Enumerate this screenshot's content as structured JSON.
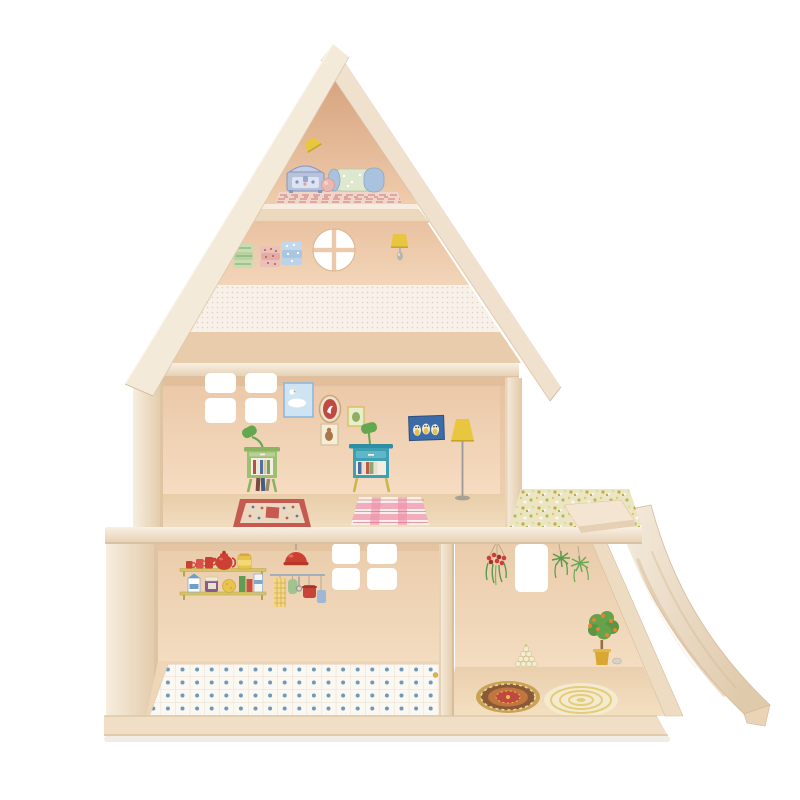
{
  "scene": {
    "type": "product-photo",
    "subject": "wooden dollhouse with gable roof, sticker-decorated rooms, side terrace and slide",
    "background": "#ffffff"
  },
  "palette": {
    "background": "#ffffff",
    "wood_light": "#f3e7d6",
    "wood_edge": "#d9bf9e",
    "wood_tan": "#e8ccab",
    "wall_peach": "#f2d3b6",
    "wall_peach_deep": "#d6a07c",
    "wallpaper_cream": "#f7f1e9",
    "tile_base": "#fbf8f1",
    "tile_dot_blue": "#4d80ab",
    "accent_red": "#cc4034",
    "accent_yellow": "#e9c63f",
    "furniture_green": "#9dbf72",
    "furniture_teal": "#3fa0b4",
    "lamp_green": "#63a84e",
    "leaf_green": "#5c9a4a",
    "owl_navy": "#3c6ca8",
    "rug_red": "#c75a50",
    "rug_pink": "#f0a8bc",
    "pot_yellow": "#d9a833",
    "meadow_base": "#ece5c4"
  },
  "inventory": {
    "attic": [
      "wall-lamp",
      "storage-chest",
      "bed-roll",
      "pink-rug"
    ],
    "upper_room": [
      "laundry-stack-green",
      "laundry-stack-red",
      "laundry-stack-blue",
      "round-window",
      "wall-lamp-with-pull"
    ],
    "bedroom": [
      "four-pane-window",
      "cloud-picture",
      "oval-frame-picture",
      "small-green-picture",
      "dog-picture",
      "owl-picture",
      "floor-lamp",
      "green-nightstand-with-lamp",
      "teal-nightstand-with-lamp",
      "oriental-rug",
      "pink-plaid-rug",
      "books"
    ],
    "kitchen": [
      "kitchen-shelves-with-crockery",
      "red-pendant-lamp",
      "utensil-rail",
      "four-pane-window",
      "blue-dotted-tile-floor"
    ],
    "living_room": [
      "window",
      "hanging-flower-basket",
      "hanging-green-plants",
      "orange-tree-in-pot",
      "bulb-pyramid",
      "mandala-rug",
      "round-yellow-rug"
    ],
    "exterior": [
      "gable-roof",
      "dotted-wallpaper-band",
      "room-divider",
      "terrace-with-meadow-sticker",
      "starting-plank",
      "curved-slide",
      "base-board"
    ]
  }
}
